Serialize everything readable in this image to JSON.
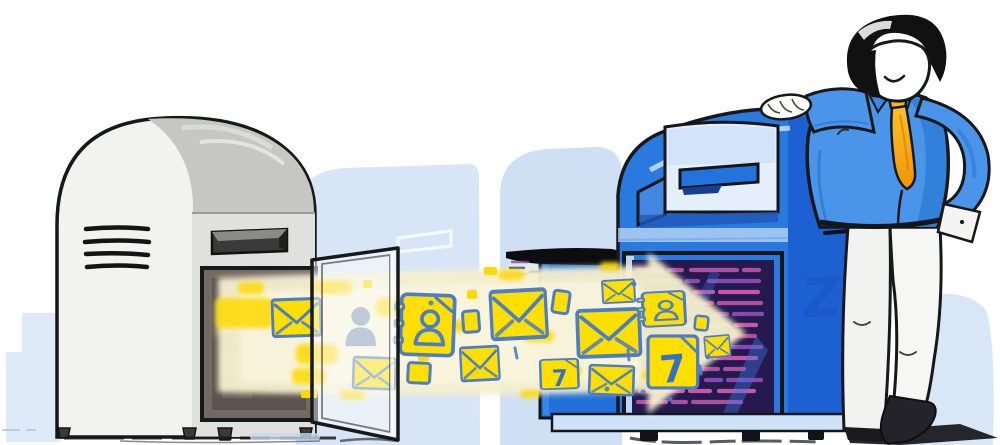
{
  "canvas": {
    "width": 1000,
    "height": 445,
    "background": "#ffffff"
  },
  "scene": {
    "subject": "mail-migration-illustration",
    "old_mailbox": {
      "style": "gray-rounded-postbox",
      "vent_count": 4,
      "door_open": true
    },
    "new_mailbox": {
      "style": "blue-collection-box",
      "vent_count": 4,
      "door_open": true,
      "watermark_letter": "Z"
    },
    "person": {
      "pose": "leaning-on-mailbox",
      "hair": "black",
      "tie": "orange",
      "smiling": true
    }
  },
  "stream": {
    "direction": "left-to-right",
    "shape": "arrow",
    "icons": [
      {
        "type": "envelope"
      },
      {
        "type": "person"
      },
      {
        "type": "address-book"
      },
      {
        "type": "card"
      },
      {
        "type": "envelope"
      },
      {
        "type": "card"
      },
      {
        "type": "envelope"
      },
      {
        "type": "card"
      },
      {
        "type": "envelope"
      },
      {
        "type": "envelope"
      },
      {
        "type": "calendar",
        "day": "7"
      },
      {
        "type": "envelope"
      },
      {
        "type": "address-book"
      },
      {
        "type": "card"
      },
      {
        "type": "calendar",
        "day": "7"
      },
      {
        "type": "envelope"
      },
      {
        "type": "envelope"
      }
    ]
  },
  "colors": {
    "background_shapes": "#d7e5f7",
    "background_shapes_deep": "#cfe0f4",
    "gray_box_front": "#f2f2f1",
    "gray_box_top": "#c6c6c5",
    "gray_box_side": "#e0e0de",
    "box_interior_gray": "#756a63",
    "blue_box_main": "#2979df",
    "blue_box_side": "#1d60d2",
    "blue_box_panel": "#e5effc",
    "blue_box_slot": "#2273dc",
    "blue_box_base": "#cfe3f8",
    "interior_navy": "#241a4f",
    "interior_magenta": "#b4539f",
    "stream_cream": "#f5efce",
    "stream_yellow": "#ffd900",
    "icon_fill": "#ffdf00",
    "icon_stroke": "#4d7ec5",
    "shirt_blue": "#4a94ea",
    "tie_orange_top": "#ffc02a",
    "tie_orange_bottom": "#ef9406",
    "pants_white": "#f2f2f0",
    "hair_black": "#111111",
    "outline_dark": "#17181a"
  }
}
